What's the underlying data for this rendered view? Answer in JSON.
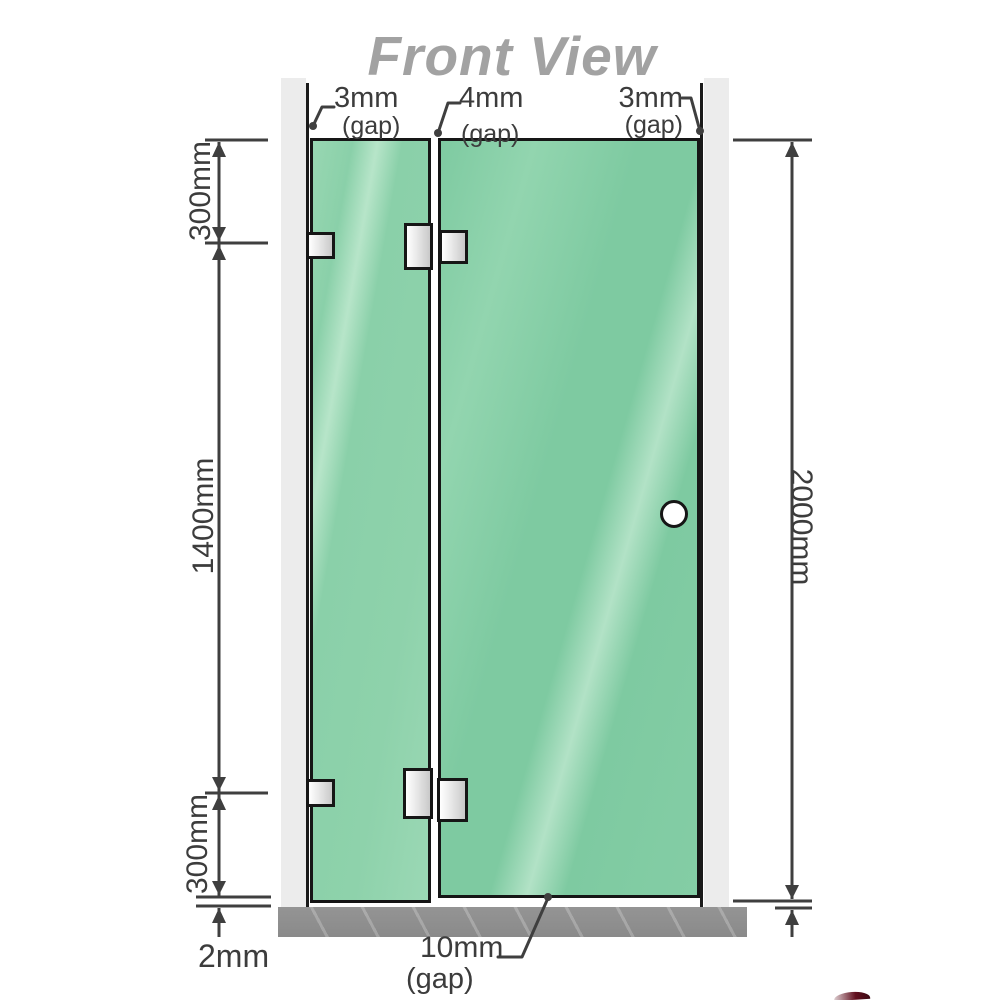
{
  "title": "Front View",
  "view": {
    "dimensions": {
      "left_top": "300mm",
      "left_middle": "1400mm",
      "left_bottom": "300mm",
      "right_height": "2000mm",
      "floor_gap": "2mm"
    },
    "gaps": {
      "top_left_value": "3mm",
      "top_left_note": "(gap)",
      "top_center_value": "4mm",
      "top_center_note": "(gap)",
      "top_right_value": "3mm",
      "top_right_note": "(gap)",
      "bottom_value": "10mm",
      "bottom_note": "(gap)"
    }
  },
  "colors": {
    "glass_green": "#8ad0a9",
    "glass_highlight": "#b7e5c9",
    "wall_gray": "#ececec",
    "floor_gray": "#8f8f8f",
    "dimension_line": "#3f3f3f",
    "title_gray": "#a2a2a2",
    "hardware_metal": "#d9d9d9",
    "corner_mark_red": "#62101f"
  }
}
